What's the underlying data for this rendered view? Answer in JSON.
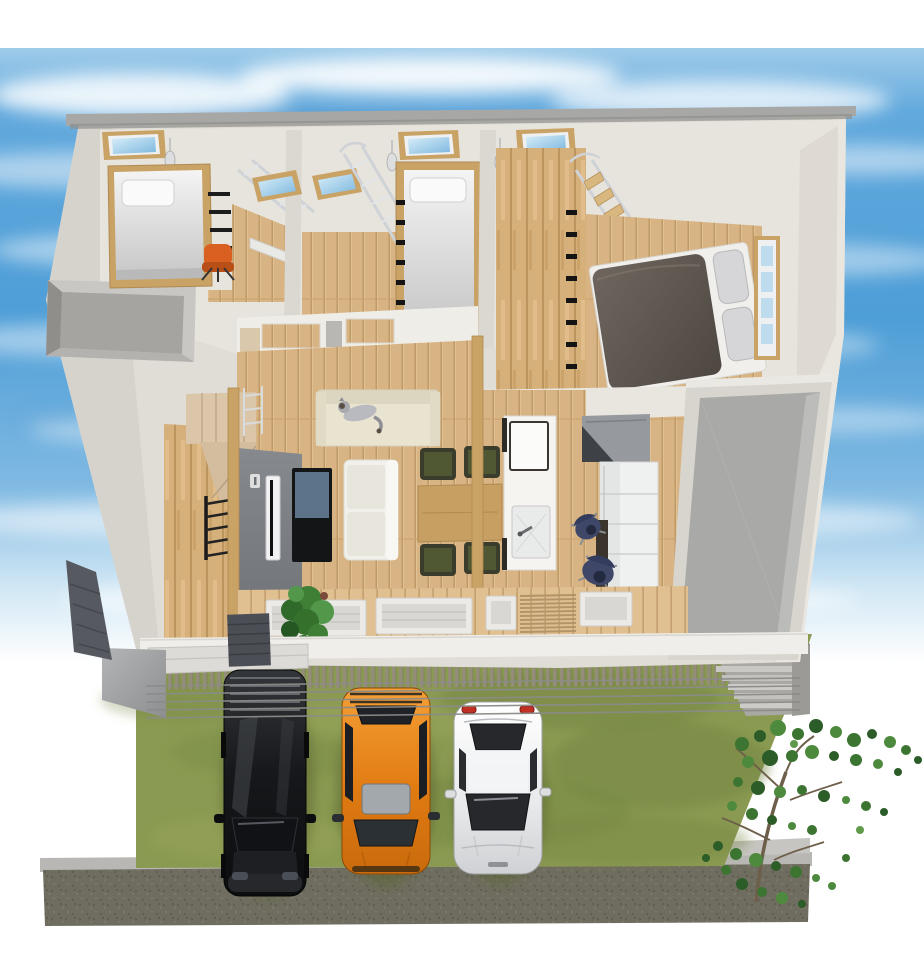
{
  "scene": {
    "title": "3D bird's-eye cutaway rendering of a two-story house",
    "description": "Dollhouse-style architectural render: attic loft bedrooms with skylights and ladders, master bedroom with dark double bed, open living-dining-kitchen floor, gray side terrace, front wood deck with slat fence, lawn with three parked cars, young tree, concrete retaining wall, blue sky with clouds"
  },
  "colors": {
    "sky_high": "#62a9dd",
    "sky_mid": "#4e9ed7",
    "sky_fade": "#cfe6f4",
    "wall_exterior": "#e0ddd6",
    "wall_shaded": "#d6d3cc",
    "wall_sunlit": "#e9e6df",
    "wall_interior": "#e7e4dd",
    "roof_edge": "#a7a7a5",
    "floor_wood": "#d8b484",
    "wood_frame": "#c9a265",
    "wall_wood": "#d6b07b",
    "deck_wood": "#e0bf90",
    "accent_wall_dark": "#6d7176",
    "stairs_tan": "#dbc6a9",
    "void_gray": "#a6a4a1",
    "terrace_floor": "#a9a9a7",
    "sofa_cream": "#e9e4d0",
    "sofa_white": "#f1f0ea",
    "cat_gray": "#b9bac0",
    "table_wood": "#c89f63",
    "chair_olive": "#4f5733",
    "island_white": "#f5f4f0",
    "appliance_gray": "#96999d",
    "appliance_dark": "#3e4246",
    "cabinet_white": "#eff0f0",
    "desk_dark": "#3a342c",
    "chair_navy": "#3e4768",
    "duvet_dark": "#4e4741",
    "mattress_white": "#f0efec",
    "pillow_gray": "#d6d6d8",
    "skylight_glass": "#7db7de",
    "window_glass": "#bfdcef",
    "ladder_metal": "#cfd2d6",
    "ladder_black": "#1a1a1a",
    "chair_orange": "#d96020",
    "tv_black": "#141517",
    "tv_screen": "#5d7389",
    "plant_green": "#3f7f35",
    "grass": "#8a9a52",
    "fence_slat": "#938d79",
    "wire_gray": "#8b8b89",
    "wall_concrete": "#6f6d5f",
    "wall_concrete_top": "#b8b7b3",
    "step_gray": "#c9c8c4",
    "van_black_hi": "#33363a",
    "van_black_lo": "#0c0d0f",
    "suv_orange_hi": "#f59f35",
    "suv_orange_lo": "#c96a0c",
    "sedan_white_hi": "#ffffff",
    "sedan_white_lo": "#cfd1d4",
    "tree_leaf": "#3c7431",
    "tree_trunk": "#6e5f4a",
    "canopy_gray": "#9fa0a2",
    "porch_dark": "#4b4e54"
  },
  "house": {
    "upper_rooms": [
      {
        "name": "left loft bedroom",
        "contents": [
          "loft single bed",
          "white pillow",
          "black wall rungs",
          "metal ladder",
          "desk",
          "orange office chair",
          "flat skylight",
          "sloped skylight",
          "pendant lamp"
        ]
      },
      {
        "name": "middle loft bedroom",
        "contents": [
          "loft single bed",
          "black wall rungs",
          "metal ladder",
          "flat skylight",
          "sloped skylight",
          "pendant lamp"
        ]
      },
      {
        "name": "loft hallway",
        "contents": [
          "wood plank wall",
          "black wall rungs",
          "ladder stair",
          "flat skylight",
          "pendant lamp"
        ]
      },
      {
        "name": "master bedroom",
        "contents": [
          "double bed",
          "dark duvet",
          "two gray pillows",
          "side window"
        ]
      }
    ],
    "main_floor": [
      "stairwell void",
      "winder staircase",
      "black loft ladder",
      "gray accent wall",
      "edge-on white TV",
      "black display with blue screen",
      "cream sofa with gray cat",
      "white two-seat sofa",
      "wood dining table",
      "four olive dining chairs",
      "two cedar posts",
      "white kitchen island with sink and board",
      "gray appliance block",
      "white cabinets",
      "dark desk",
      "two navy office chairs",
      "potted green plant"
    ],
    "outside": [
      "gray side terrace",
      "front deck with sliding-door sills",
      "slatted engawa deck",
      "porch step",
      "dark porch roof",
      "gray canopy",
      "slat fence"
    ]
  },
  "yard": {
    "lawn": "olive green grass",
    "power_lines": 5,
    "stepped_ramp": "gray steps at right",
    "retaining_wall": "dark speckled concrete with light cap",
    "tree": "young sparse-leaf tree at right"
  },
  "vehicles": [
    {
      "type": "minivan",
      "color": "black",
      "position": "left parking spot"
    },
    {
      "type": "compact SUV",
      "color": "orange",
      "position": "middle parking spot"
    },
    {
      "type": "sedan",
      "color": "white",
      "position": "right parking spot"
    }
  ],
  "pets": [
    {
      "type": "cat",
      "color": "gray and white",
      "location": "lying on cream sofa"
    }
  ]
}
